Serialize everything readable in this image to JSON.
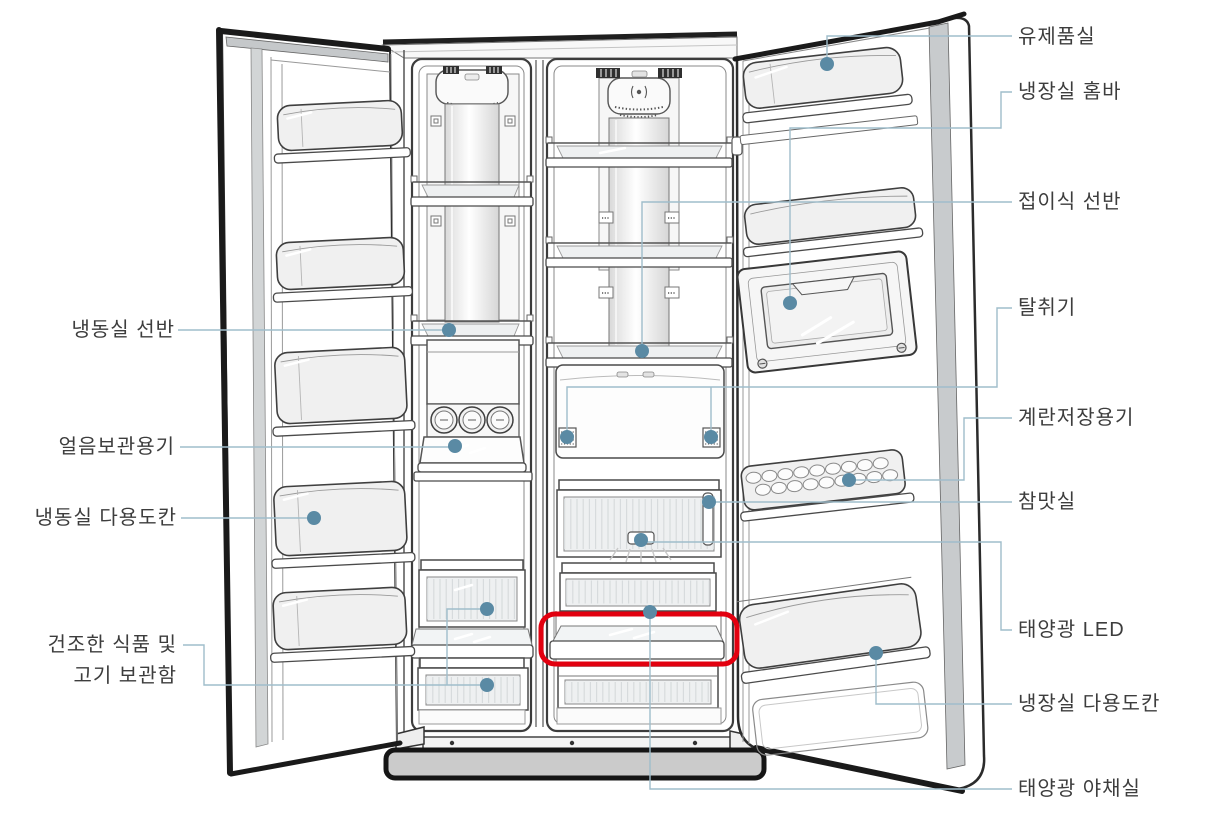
{
  "diagram": {
    "type": "refrigerator-parts-diagram",
    "colors": {
      "callout_line": "#9fbdcb",
      "callout_dot": "#5a8aa4",
      "highlight_box": "#e2000f",
      "label_text": "#3d3d3d",
      "line_art": "#3f3f3f"
    },
    "labels_right": [
      {
        "id": "dairy-room",
        "text": "유제품실"
      },
      {
        "id": "fridge-home-bar",
        "text": "냉장실 홈바"
      },
      {
        "id": "folding-shelf",
        "text": "접이식 선반"
      },
      {
        "id": "deodorizer",
        "text": "탈취기"
      },
      {
        "id": "egg-container",
        "text": "계란저장용기"
      },
      {
        "id": "chammat-room",
        "text": "참맛실"
      },
      {
        "id": "solar-led",
        "text": "태양광 LED"
      },
      {
        "id": "fridge-utility-bin",
        "text": "냉장실 다용도칸"
      },
      {
        "id": "solar-veg-room",
        "text": "태양광 야채실"
      }
    ],
    "labels_left": [
      {
        "id": "freezer-shelf",
        "text": "냉동실 선반"
      },
      {
        "id": "ice-container",
        "text": "얼음보관용기"
      },
      {
        "id": "freezer-utility-bin",
        "text": "냉동실 다용도칸"
      },
      {
        "id": "dry-food-meat-box",
        "line1": "건조한 식품 및",
        "line2": "고기 보관함"
      }
    ]
  }
}
